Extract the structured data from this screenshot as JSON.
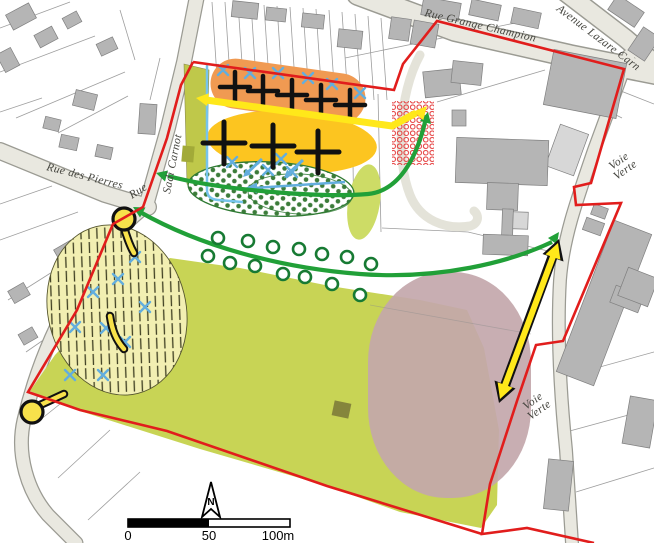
{
  "map": {
    "street_labels": {
      "grange_champion": "Rue Grange Champion",
      "avenue_lazare": "Avenue Lazare Carn",
      "rue_des_pierres": "Rue des Pierres",
      "rue": "Rue",
      "sadi_carnot": "Sadi Carnot",
      "voie_verte_upper_1": "Voie",
      "voie_verte_upper_2": "Verte",
      "voie_verte_lower_1": "Voie",
      "voie_verte_lower_2": "Verte"
    },
    "scale_bar": {
      "start": "0",
      "mid": "50",
      "end": "100m"
    },
    "compass": {
      "north": "N"
    },
    "colors": {
      "background": "#ffffff",
      "street_fill": "#e9e8e0",
      "street_casing": "#9b9b93",
      "path_fill": "#e4e3d9",
      "building": "#b5b5b5",
      "building_light": "#d7d7d7",
      "building_stroke": "#7f7f7f",
      "parcel_line": "#8c8c8c",
      "label_text": "#45453f",
      "site_boundary": "#e11d1c",
      "field": "#c8d455",
      "olive_strip": "#bfc84a",
      "olive_dark": "#a2aa38",
      "olive_square": "#85853c",
      "orange_zone": "#f09a52",
      "yellow_zone": "#fcc520",
      "hatch_fill": "#f2efb2",
      "hatch_line": "#3f3f22",
      "hatch_edge": "#55552e",
      "hedge_outline": "#2f7a33",
      "hedge_dot": "#3c7c3a",
      "lime_patch": "#cddc66",
      "mauve": "#c3a7ab",
      "red_hatch": "#e43a3a",
      "green_arrow": "#21a038",
      "tree_circle": "#177a33",
      "yellow_arrow": "#ffe81a",
      "black": "#111111",
      "blue_mark": "#63aede",
      "cyan_line": "#76c4ec",
      "pin_yellow": "#f7e14b",
      "scale_black": "#000000"
    }
  }
}
